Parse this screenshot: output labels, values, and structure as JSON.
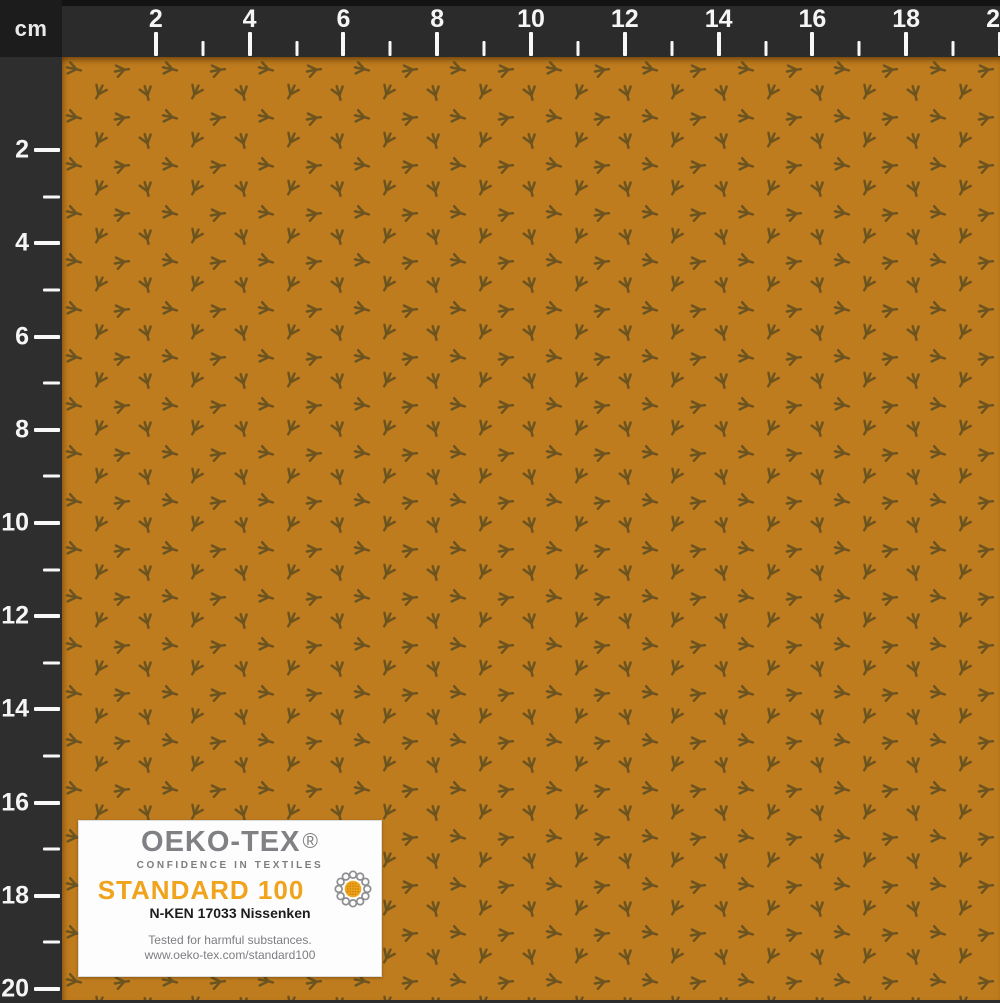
{
  "ruler": {
    "unit": "cm",
    "top_labels": [
      "2",
      "4",
      "6",
      "8",
      "10",
      "12",
      "14",
      "16",
      "18",
      "20"
    ],
    "left_labels": [
      "2",
      "4",
      "6",
      "8",
      "10",
      "12",
      "14",
      "16",
      "18",
      "20"
    ]
  },
  "fabric": {
    "description": "Mustard ochre fabric with small dark olive bird-footprint motifs",
    "background_color": "#bf7c1e",
    "motif_color": "#655020",
    "motif_name": "bird-footprint-motif"
  },
  "certification_label": {
    "brand": "OEKO-TEX",
    "registered_mark": "®",
    "tagline": "CONFIDENCE IN TEXTILES",
    "standard": "STANDARD 100",
    "certificate_number": "N-KEN 17033 Nissenken",
    "note": "Tested for harmful substances.",
    "url": "www.oeko-tex.com/standard100",
    "accent_color": "#f0a31c",
    "logo_loop_color": "#8d8e90",
    "logo_globe_color": "#f0a31c",
    "logo_globe_dot_color": "#c9830b"
  }
}
